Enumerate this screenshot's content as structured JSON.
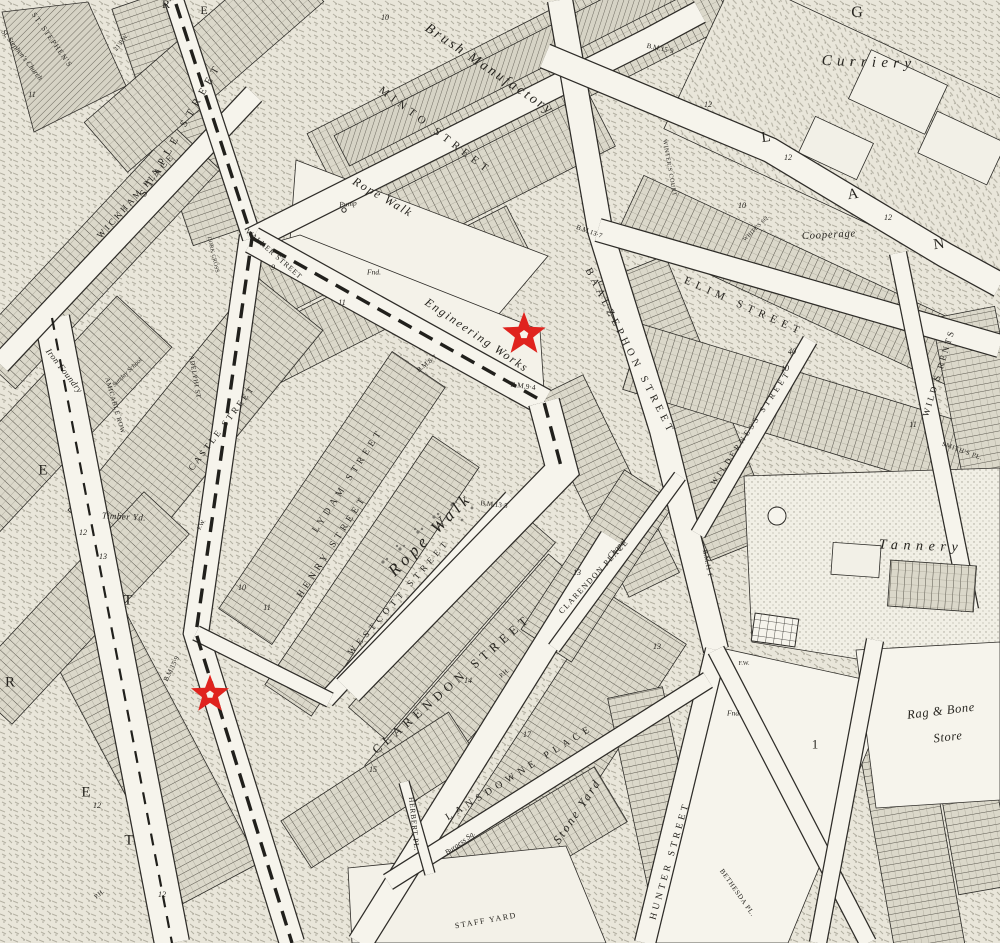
{
  "map": {
    "kind": "historic-ordnance-survey-town-plan-extract",
    "colors": {
      "paper": "#efede4",
      "street_fill": "#f6f4ec",
      "ink": "#26241f",
      "marker_red": "#e0231e",
      "marker_core": "#f6f4ec"
    },
    "markers": [
      {
        "name": "star-marker-1",
        "x": 524,
        "y": 337,
        "size": 50
      },
      {
        "name": "star-marker-2",
        "x": 210,
        "y": 697,
        "size": 44
      }
    ],
    "labels": [
      {
        "t": "MINTO STREET",
        "x": 435,
        "y": 131,
        "r": 37,
        "s": 11,
        "c": "street",
        "ls": 0.45
      },
      {
        "t": "WALKER STREET",
        "x": 274,
        "y": 254,
        "r": 41,
        "s": 7.5,
        "c": "street",
        "ls": 0.12
      },
      {
        "t": "STAPLE STREET",
        "x": 182,
        "y": 130,
        "r": -60,
        "s": 10.5,
        "c": "street",
        "ls": 0.55
      },
      {
        "t": "WICKHAM PLACE",
        "x": 136,
        "y": 196,
        "r": -48,
        "s": 9,
        "c": "street",
        "ls": 0.3
      },
      {
        "t": "CASTLE STREET",
        "x": 222,
        "y": 428,
        "r": -53,
        "s": 9,
        "c": "street",
        "ls": 0.3
      },
      {
        "t": "LYDAM STREET",
        "x": 349,
        "y": 481,
        "r": -57,
        "s": 9.5,
        "c": "street",
        "ls": 0.45
      },
      {
        "t": "HENRY STREET",
        "x": 333,
        "y": 547,
        "r": -57,
        "s": 9.5,
        "c": "street",
        "ls": 0.45
      },
      {
        "t": "WESTCOTT STREET",
        "x": 399,
        "y": 597,
        "r": -49,
        "s": 9,
        "c": "street",
        "ls": 0.5
      },
      {
        "t": "CLARENDON STREET",
        "x": 452,
        "y": 684,
        "r": -41,
        "s": 12.5,
        "c": "street",
        "ls": 0.4
      },
      {
        "t": "CLARENDON PLACE",
        "x": 594,
        "y": 577,
        "r": -47,
        "s": 8,
        "c": "street",
        "ls": 0.18
      },
      {
        "t": "LANSDOWNE PLACE",
        "x": 520,
        "y": 773,
        "r": -32,
        "s": 10,
        "c": "street",
        "ls": 0.5
      },
      {
        "t": "HERBERT PL.",
        "x": 414,
        "y": 824,
        "r": 84,
        "s": 7.5,
        "c": "street",
        "ls": 0.1
      },
      {
        "t": "STAFF YARD",
        "x": 486,
        "y": 921,
        "r": -10,
        "s": 8,
        "c": "street",
        "ls": 0.2
      },
      {
        "t": "HUNTER STREET",
        "x": 671,
        "y": 861,
        "r": -74,
        "s": 9.5,
        "c": "street",
        "ls": 0.38
      },
      {
        "t": "BAALZEPHON STREET",
        "x": 629,
        "y": 352,
        "r": 63,
        "s": 10.5,
        "c": "street",
        "ls": 0.42
      },
      {
        "t": "ELIM STREET",
        "x": 744,
        "y": 307,
        "r": 24,
        "s": 11,
        "c": "street",
        "ls": 0.5
      },
      {
        "t": "WILDERNESS STREET",
        "x": 751,
        "y": 428,
        "r": -56,
        "s": 8,
        "c": "street",
        "ls": 0.4
      },
      {
        "t": "WILD'S RENTS",
        "x": 939,
        "y": 373,
        "r": -73,
        "s": 9,
        "c": "street",
        "ls": 0.28
      },
      {
        "t": "SMITH'S PL.",
        "x": 962,
        "y": 452,
        "r": 20,
        "s": 6.5,
        "c": "street",
        "ls": 0.1
      },
      {
        "t": "WINTER'S COURT",
        "x": 669,
        "y": 168,
        "r": 80,
        "s": 6,
        "c": "street",
        "ls": 0.1
      },
      {
        "t": "AMICABLE ROW",
        "x": 114,
        "y": 406,
        "r": 74,
        "s": 6.5,
        "c": "street",
        "ls": 0.1
      },
      {
        "t": "ADELPHI ST.",
        "x": 194,
        "y": 378,
        "r": 80,
        "s": 6.5,
        "c": "street",
        "ls": 0.1
      },
      {
        "t": "BETHESDA PL.",
        "x": 737,
        "y": 893,
        "r": 55,
        "s": 7,
        "c": "street",
        "ls": 0.1
      },
      {
        "t": "ST. STEPHEN'S",
        "x": 52,
        "y": 40,
        "r": 55,
        "s": 7.5,
        "c": "street",
        "ls": 0.15
      },
      {
        "t": "WHITE'S SQ.",
        "x": 757,
        "y": 229,
        "r": -45,
        "s": 5.5,
        "c": "street",
        "ls": 0.05
      },
      {
        "t": "DORK CROSS",
        "x": 212,
        "y": 255,
        "r": 77,
        "s": 5.5,
        "c": "street",
        "ls": 0.05
      },
      {
        "t": "Brush Manufactory",
        "x": 489,
        "y": 70,
        "r": 34,
        "s": 14,
        "c": "place",
        "ls": 0.18
      },
      {
        "t": "Rope Walk",
        "x": 383,
        "y": 197,
        "r": 30,
        "s": 12,
        "c": "place",
        "ls": 0.15
      },
      {
        "t": "Rope Walk",
        "x": 430,
        "y": 534,
        "r": -45,
        "s": 17,
        "c": "place",
        "ls": 0.25
      },
      {
        "t": "Engineering Works",
        "x": 477,
        "y": 335,
        "r": 34,
        "s": 12,
        "c": "place",
        "ls": 0.15
      },
      {
        "t": "Curriery",
        "x": 869,
        "y": 63,
        "r": 2,
        "s": 15,
        "c": "place",
        "ls": 0.35
      },
      {
        "t": "Cooperage",
        "x": 829,
        "y": 236,
        "r": -3,
        "s": 10.5,
        "c": "place",
        "ls": 0.08
      },
      {
        "t": "Tannery",
        "x": 921,
        "y": 547,
        "r": 2,
        "s": 14,
        "c": "place",
        "ls": 0.4
      },
      {
        "t": "Rag & Bone",
        "x": 941,
        "y": 711,
        "r": -7,
        "s": 12.5,
        "c": "place",
        "ls": 0.05
      },
      {
        "t": "Store",
        "x": 948,
        "y": 737,
        "r": -7,
        "s": 12.5,
        "c": "place",
        "ls": 0.05
      },
      {
        "t": "Stone Yard",
        "x": 577,
        "y": 811,
        "r": -56,
        "s": 12,
        "c": "place",
        "ls": 0.2
      },
      {
        "t": "Iron Foundry",
        "x": 64,
        "y": 371,
        "r": 52,
        "s": 9,
        "c": "place",
        "ls": 0.05
      },
      {
        "t": "Timber Yd.",
        "x": 124,
        "y": 517,
        "r": 3,
        "s": 9,
        "c": "place",
        "ls": 0.05
      },
      {
        "t": "St. Stephen's Church",
        "x": 22,
        "y": 55,
        "r": 52,
        "s": 7.5,
        "c": "place",
        "ls": 0
      },
      {
        "t": "Sunday School",
        "x": 128,
        "y": 373,
        "r": -44,
        "s": 6.5,
        "c": "place",
        "ls": 0
      },
      {
        "t": "Pump",
        "x": 348,
        "y": 204,
        "r": -5,
        "s": 7.5,
        "c": "place",
        "ls": 0
      },
      {
        "t": "Fnd.",
        "x": 374,
        "y": 272,
        "r": 0,
        "s": 7.5,
        "c": "place",
        "ls": 0
      },
      {
        "t": "Fnd.",
        "x": 734,
        "y": 713,
        "r": 0,
        "s": 7.5,
        "c": "place",
        "ls": 0
      },
      {
        "t": "Chapel",
        "x": 617,
        "y": 549,
        "r": -48,
        "s": 8,
        "c": "place",
        "ls": 0
      },
      {
        "t": "Burgess Sq.",
        "x": 460,
        "y": 843,
        "r": -36,
        "s": 7.5,
        "c": "place",
        "ls": 0
      },
      {
        "t": "B.M.13·7",
        "x": 589,
        "y": 232,
        "r": 20,
        "s": 7,
        "c": "tiny",
        "ls": 0
      },
      {
        "t": "B.M.15·9",
        "x": 660,
        "y": 49,
        "r": 12,
        "s": 7,
        "c": "tiny",
        "ls": 0
      },
      {
        "t": "B.M.9·4",
        "x": 523,
        "y": 386,
        "r": 8,
        "s": 7.5,
        "c": "tiny",
        "ls": 0
      },
      {
        "t": "B.M.8·7",
        "x": 427,
        "y": 364,
        "r": -38,
        "s": 7,
        "c": "tiny",
        "ls": 0
      },
      {
        "t": "B.M.13·5",
        "x": 494,
        "y": 505,
        "r": 6,
        "s": 7,
        "c": "tiny",
        "ls": 0
      },
      {
        "t": "B.M.15·9",
        "x": 172,
        "y": 669,
        "r": -64,
        "s": 7,
        "c": "tiny",
        "ls": 0
      },
      {
        "t": "B.M.11·1",
        "x": 707,
        "y": 563,
        "r": 78,
        "s": 7,
        "c": "tiny",
        "ls": 0
      },
      {
        "t": "P.H.",
        "x": 505,
        "y": 674,
        "r": -40,
        "s": 6.5,
        "c": "tiny",
        "ls": 0
      },
      {
        "t": "P.H.",
        "x": 100,
        "y": 895,
        "r": -40,
        "s": 6.5,
        "c": "tiny",
        "ls": 0
      },
      {
        "t": "21 P.W.",
        "x": 122,
        "y": 43,
        "r": -52,
        "s": 6.5,
        "c": "tiny",
        "ls": 0
      },
      {
        "t": "F.W.",
        "x": 744,
        "y": 664,
        "r": 0,
        "s": 6,
        "c": "tiny",
        "ls": 0
      },
      {
        "t": "F.W.",
        "x": 202,
        "y": 525,
        "r": -60,
        "s": 6,
        "c": "tiny",
        "ls": 0
      },
      {
        "t": "G",
        "x": 857,
        "y": 13,
        "r": 0,
        "s": 16,
        "c": "big",
        "ls": 0
      },
      {
        "t": "L",
        "x": 766,
        "y": 138,
        "r": -8,
        "s": 15,
        "c": "big",
        "ls": 0
      },
      {
        "t": "A",
        "x": 853,
        "y": 195,
        "r": -8,
        "s": 15,
        "c": "big",
        "ls": 0
      },
      {
        "t": "N",
        "x": 939,
        "y": 245,
        "r": -8,
        "s": 15,
        "c": "big",
        "ls": 0
      },
      {
        "t": "E",
        "x": 43,
        "y": 471,
        "r": 0,
        "s": 15,
        "c": "big",
        "ls": 0
      },
      {
        "t": "T",
        "x": 128,
        "y": 601,
        "r": 0,
        "s": 15,
        "c": "big",
        "ls": 0
      },
      {
        "t": "R",
        "x": 10,
        "y": 683,
        "r": 0,
        "s": 15,
        "c": "big",
        "ls": 0
      },
      {
        "t": "E",
        "x": 86,
        "y": 793,
        "r": 0,
        "s": 15,
        "c": "big",
        "ls": 0
      },
      {
        "t": "T",
        "x": 129,
        "y": 841,
        "r": 0,
        "s": 15,
        "c": "big",
        "ls": 0
      },
      {
        "t": "R",
        "x": 166,
        "y": 4,
        "r": 0,
        "s": 12,
        "c": "big",
        "ls": 0
      },
      {
        "t": "E",
        "x": 204,
        "y": 10,
        "r": 0,
        "s": 12,
        "c": "big",
        "ls": 0
      },
      {
        "t": "1",
        "x": 815,
        "y": 744,
        "r": 0,
        "s": 13,
        "c": "big",
        "ls": 0
      },
      {
        "t": "12",
        "x": 708,
        "y": 105,
        "r": 0,
        "s": 8,
        "c": "num",
        "ls": 0
      },
      {
        "t": "12",
        "x": 788,
        "y": 158,
        "r": 0,
        "s": 8,
        "c": "num",
        "ls": 0
      },
      {
        "t": "12",
        "x": 888,
        "y": 218,
        "r": 0,
        "s": 8,
        "c": "num",
        "ls": 0
      },
      {
        "t": "10",
        "x": 742,
        "y": 206,
        "r": 0,
        "s": 8,
        "c": "num",
        "ls": 0
      },
      {
        "t": "10",
        "x": 785,
        "y": 369,
        "r": 0,
        "s": 8,
        "c": "num",
        "ls": 0
      },
      {
        "t": "9",
        "x": 273,
        "y": 268,
        "r": 0,
        "s": 8,
        "c": "num",
        "ls": 0
      },
      {
        "t": "11",
        "x": 342,
        "y": 303,
        "r": 0,
        "s": 8,
        "c": "num",
        "ls": 0
      },
      {
        "t": "10",
        "x": 242,
        "y": 588,
        "r": 0,
        "s": 8,
        "c": "num",
        "ls": 0
      },
      {
        "t": "11",
        "x": 267,
        "y": 608,
        "r": 0,
        "s": 8,
        "c": "num",
        "ls": 0
      },
      {
        "t": "12",
        "x": 83,
        "y": 533,
        "r": 0,
        "s": 8,
        "c": "num",
        "ls": 0
      },
      {
        "t": "13",
        "x": 103,
        "y": 557,
        "r": 0,
        "s": 8,
        "c": "num",
        "ls": 0
      },
      {
        "t": "12",
        "x": 97,
        "y": 806,
        "r": 0,
        "s": 8,
        "c": "num",
        "ls": 0
      },
      {
        "t": "12",
        "x": 162,
        "y": 895,
        "r": 0,
        "s": 8,
        "c": "num",
        "ls": 0
      },
      {
        "t": "13",
        "x": 577,
        "y": 573,
        "r": 0,
        "s": 8,
        "c": "num",
        "ls": 0
      },
      {
        "t": "14",
        "x": 468,
        "y": 681,
        "r": 0,
        "s": 8,
        "c": "num",
        "ls": 0
      },
      {
        "t": "15",
        "x": 373,
        "y": 770,
        "r": 0,
        "s": 8,
        "c": "num",
        "ls": 0
      },
      {
        "t": "13",
        "x": 657,
        "y": 647,
        "r": 0,
        "s": 8,
        "c": "num",
        "ls": 0
      },
      {
        "t": "11",
        "x": 913,
        "y": 425,
        "r": 0,
        "s": 8,
        "c": "num",
        "ls": 0
      },
      {
        "t": "11",
        "x": 32,
        "y": 95,
        "r": 0,
        "s": 8,
        "c": "num",
        "ls": 0
      },
      {
        "t": "17",
        "x": 527,
        "y": 735,
        "r": 0,
        "s": 8,
        "c": "num",
        "ls": 0
      },
      {
        "t": "10",
        "x": 385,
        "y": 18,
        "r": 0,
        "s": 8,
        "c": "num",
        "ls": 0
      },
      {
        "t": "40",
        "x": 792,
        "y": 352,
        "r": 0,
        "s": 8,
        "c": "num",
        "ls": 0
      }
    ]
  }
}
